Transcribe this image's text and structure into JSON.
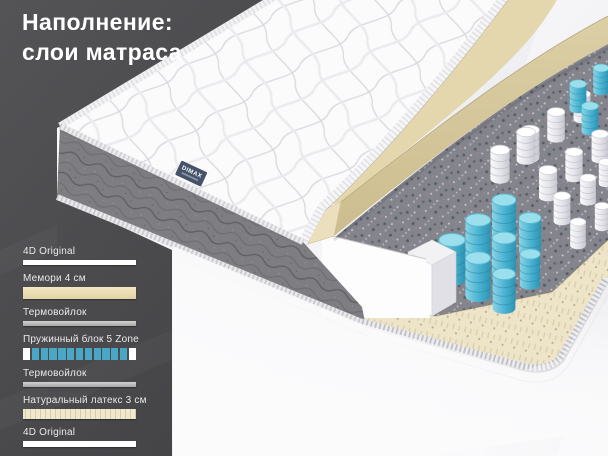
{
  "title": {
    "line1": "Наполнение:",
    "line2": "слои матраса"
  },
  "brand_label": "DIMAX",
  "legend": {
    "items": [
      {
        "label": "4D Original",
        "swatch": "fabric-white"
      },
      {
        "label": "Мемори 4 см",
        "swatch": "memory-beige"
      },
      {
        "label": "Термовойлок",
        "swatch": "felt-gray"
      },
      {
        "label": "Пружинный блок 5 Zone",
        "swatch": "springs-blue"
      },
      {
        "label": "Термовойлок",
        "swatch": "felt-gray"
      },
      {
        "label": "Натуральный латекс 3 см",
        "swatch": "latex-cream"
      },
      {
        "label": "4D Original",
        "swatch": "fabric-white"
      }
    ]
  },
  "colors": {
    "panel_dark": "#4b4b4e",
    "spring_blue": "#4ba6c6",
    "memory_beige": "#e4d7ad",
    "latex_cream": "#eee5c9",
    "felt_gray": "#85858d",
    "brand_tag_navy": "#46536a",
    "title_text": "#ffffff"
  }
}
